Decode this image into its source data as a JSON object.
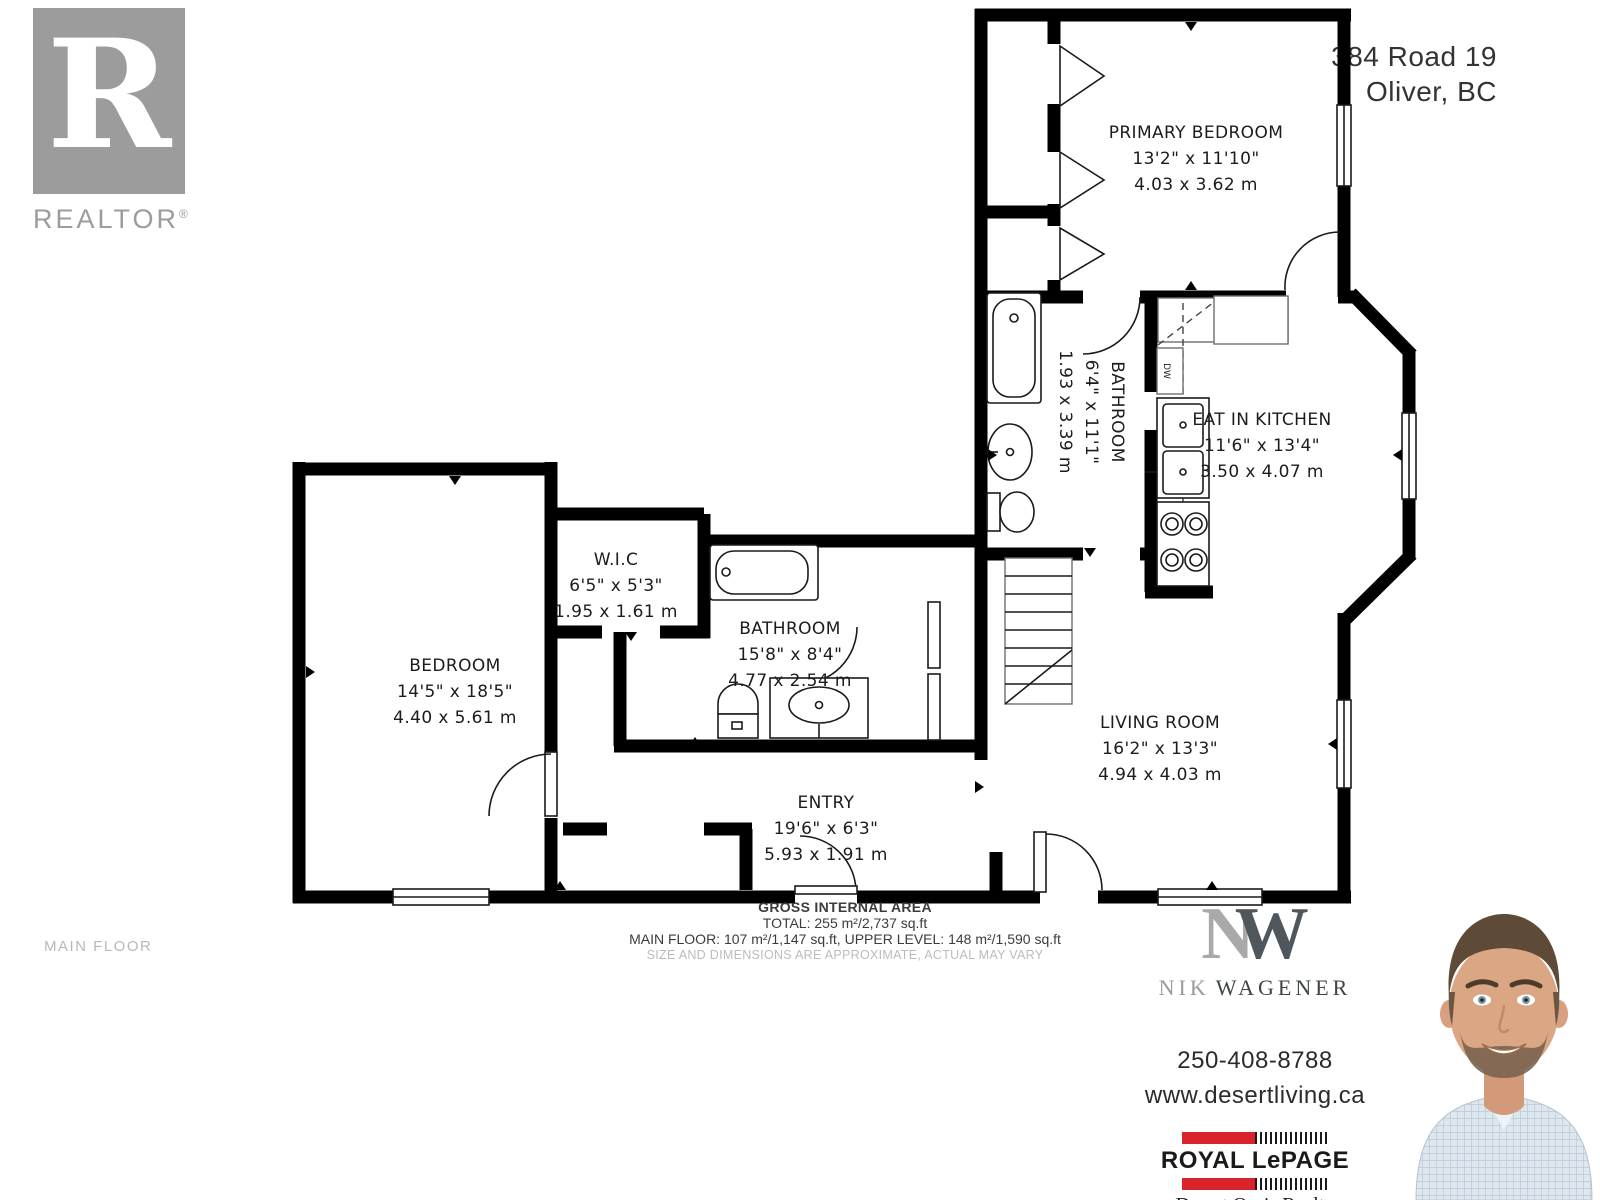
{
  "address": {
    "line1": "384 Road 19",
    "line2": "Oliver, BC"
  },
  "floor_label": "MAIN FLOOR",
  "realtor_logo": {
    "letter": "R",
    "wordmark": "REALTOR",
    "registered": "®"
  },
  "rooms": {
    "primary_bedroom": {
      "name": "PRIMARY BEDROOM",
      "imperial": "13'2\" x 11'10\"",
      "metric": "4.03 x 3.62 m"
    },
    "bathroom_upper": {
      "name": "BATHROOM",
      "imperial": "6'4\" x 11'1\"",
      "metric": "1.93 x 3.39 m"
    },
    "eat_in_kitchen": {
      "name": "EAT IN KITCHEN",
      "imperial": "11'6\" x 13'4\"",
      "metric": "3.50 x 4.07 m"
    },
    "wic": {
      "name": "W.I.C",
      "imperial": "6'5\" x 5'3\"",
      "metric": "1.95 x 1.61 m"
    },
    "bedroom": {
      "name": "BEDROOM",
      "imperial": "14'5\" x 18'5\"",
      "metric": "4.40 x 5.61 m"
    },
    "bathroom_main": {
      "name": "BATHROOM",
      "imperial": "15'8\" x 8'4\"",
      "metric": "4.77 x 2.54 m"
    },
    "entry": {
      "name": "ENTRY",
      "imperial": "19'6\" x 6'3\"",
      "metric": "5.93 x 1.91 m"
    },
    "living_room": {
      "name": "LIVING ROOM",
      "imperial": "16'2\" x 13'3\"",
      "metric": "4.94 x 4.03 m"
    }
  },
  "fixtures": {
    "dishwasher_label": "DW"
  },
  "area_summary": {
    "title": "GROSS INTERNAL AREA",
    "total": "TOTAL: 255 m²/2,737 sq.ft",
    "breakdown": "MAIN FLOOR: 107 m²/1,147 sq.ft, UPPER LEVEL: 148 m²/1,590 sq.ft",
    "disclaimer": "SIZE AND DIMENSIONS ARE APPROXIMATE, ACTUAL MAY VARY"
  },
  "agent": {
    "monogram_n": "N",
    "monogram_w": "W",
    "first_name": "NIK",
    "last_name": "WAGENER",
    "phone": "250-408-8788",
    "website": "www.desertliving.ca"
  },
  "brokerage": {
    "name": "ROYAL LePAGE",
    "office": "Desert Oasis Realty",
    "tagline": "Independently Owned And Opperated, Broker"
  },
  "colors": {
    "wall": "#000000",
    "accent_red": "#d9222a",
    "logo_gray": "#9c9c9c",
    "muted_gray": "#b9b9b9",
    "text_dark": "#2b2b2b"
  }
}
